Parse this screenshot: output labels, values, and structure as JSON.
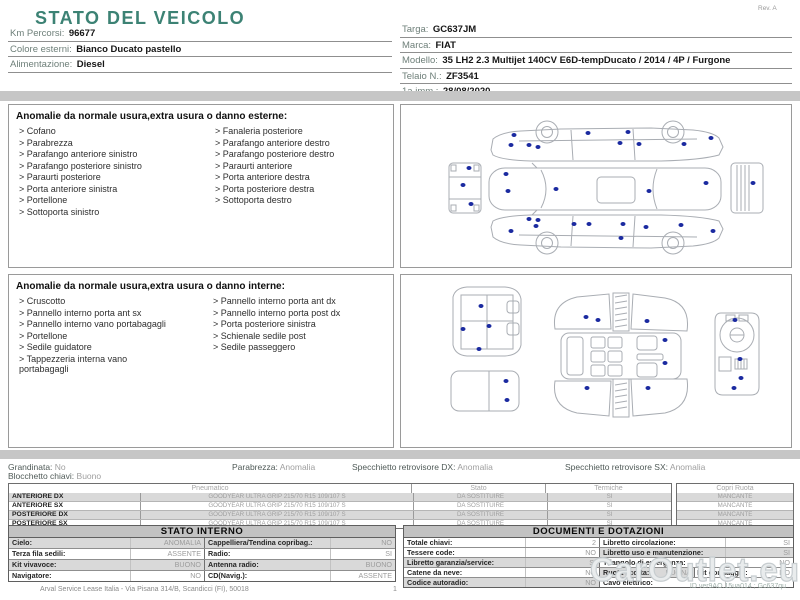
{
  "colors": {
    "accent_teal": "#3c8274",
    "damage_dot": "#1b2aa0",
    "band_gray": "#c6c6c6",
    "shade_gray": "#d9d9d9"
  },
  "header": {
    "title": "STATO DEL VEICOLO",
    "rev": "Rev. A",
    "left_fields": [
      {
        "label": "Km Percorsi:",
        "value": "96677"
      },
      {
        "label": "Colore esterni:",
        "value": "Bianco Ducato pastello"
      },
      {
        "label": "Alimentazione:",
        "value": "Diesel"
      }
    ],
    "right_fields": [
      {
        "label": "Targa:",
        "value": "GC637JM"
      },
      {
        "label": "Marca:",
        "value": "FIAT"
      },
      {
        "label": "Modello:",
        "value": "35 LH2 2.3 Multijet 140CV E6D-tempDucato / 2014 / 4P / Furgone"
      },
      {
        "label": "Telaio N.:",
        "value": "ZF3541"
      },
      {
        "label": "1a imm.:",
        "value": "28/08/2020"
      }
    ]
  },
  "exterior": {
    "title": "Anomalie da normale usura,extra usura o danno esterne:",
    "items_left": [
      "Cofano",
      "Parabrezza",
      "Parafango anteriore sinistro",
      "Parafango posteriore sinistro",
      "Paraurti posteriore",
      "Porta anteriore sinistra",
      "Portellone",
      "Sottoporta sinistro"
    ],
    "items_right": [
      "Fanaleria posteriore",
      "Parafango anteriore destro",
      "Parafango posteriore destro",
      "Paraurti anteriore",
      "Porta anteriore destra",
      "Porta posteriore destra",
      "Sottoporta destro"
    ],
    "dots": [
      [
        113,
        30
      ],
      [
        128,
        40
      ],
      [
        137,
        42
      ],
      [
        110,
        40
      ],
      [
        187,
        28
      ],
      [
        219,
        38
      ],
      [
        227,
        27
      ],
      [
        238,
        39
      ],
      [
        283,
        39
      ],
      [
        310,
        33
      ],
      [
        68,
        63
      ],
      [
        62,
        80
      ],
      [
        70,
        99
      ],
      [
        105,
        69
      ],
      [
        107,
        86
      ],
      [
        155,
        84
      ],
      [
        248,
        86
      ],
      [
        305,
        78
      ],
      [
        352,
        78
      ],
      [
        128,
        114
      ],
      [
        137,
        115
      ],
      [
        135,
        121
      ],
      [
        110,
        126
      ],
      [
        173,
        119
      ],
      [
        188,
        119
      ],
      [
        222,
        119
      ],
      [
        245,
        122
      ],
      [
        280,
        120
      ],
      [
        312,
        126
      ],
      [
        220,
        133
      ]
    ]
  },
  "interior": {
    "title": "Anomalie da normale usura,extra usura o danno interne:",
    "items_left": [
      "Cruscotto",
      "Pannello interno porta ant sx",
      "Pannello interno vano portabagagli",
      "Portellone",
      "Sedile guidatore",
      "Tappezzeria interna vano portabagagli"
    ],
    "items_right": [
      "Pannello interno porta ant dx",
      "Pannello interno porta post dx",
      "Porta posteriore sinistra",
      "Schienale sedile post",
      "Sedile passeggero"
    ],
    "dots": [
      [
        80,
        31
      ],
      [
        88,
        51
      ],
      [
        62,
        54
      ],
      [
        78,
        74
      ],
      [
        105,
        106
      ],
      [
        106,
        125
      ],
      [
        185,
        42
      ],
      [
        197,
        45
      ],
      [
        246,
        46
      ],
      [
        264,
        65
      ],
      [
        264,
        88
      ],
      [
        186,
        113
      ],
      [
        247,
        113
      ],
      [
        334,
        45
      ],
      [
        339,
        84
      ],
      [
        340,
        103
      ],
      [
        333,
        113
      ]
    ]
  },
  "status_line": {
    "items": [
      {
        "label": "Grandinata:",
        "value": "No"
      },
      {
        "label": "Parabrezza:",
        "value": "Anomalia"
      },
      {
        "label": "Specchietto retrovisore DX:",
        "value": "Anomalia"
      },
      {
        "label": "Specchietto retrovisore SX:",
        "value": "Anomalia"
      }
    ],
    "second_row": {
      "label": "Blocchetto chiavi:",
      "value": "Buono"
    }
  },
  "tyres": {
    "headers": [
      "Pneumatico",
      "Stato",
      "Termiche",
      "Copri Ruota"
    ],
    "rows": [
      {
        "pos": "ANTERIORE DX",
        "tyre": "GOODYEAR ULTRA GRIP 215/70 R15 109/107 S",
        "stato": "DA SOSTITUIRE",
        "termiche": "SI",
        "copri": "MANCANTE",
        "shaded": true
      },
      {
        "pos": "ANTERIORE SX",
        "tyre": "GOODYEAR ULTRA GRIP 215/70 R15 109/107 S",
        "stato": "DA SOSTITUIRE",
        "termiche": "SI",
        "copri": "MANCANTE",
        "shaded": false
      },
      {
        "pos": "POSTERIORE DX",
        "tyre": "GOODYEAR ULTRA GRIP 215/70 R15 109/107 S",
        "stato": "DA SOSTITUIRE",
        "termiche": "SI",
        "copri": "MANCANTE",
        "shaded": true
      },
      {
        "pos": "POSTERIORE SX",
        "tyre": "GOODYEAR ULTRA GRIP 215/70 R15 109/107 S",
        "stato": "DA SOSTITUIRE",
        "termiche": "SI",
        "copri": "MANCANTE",
        "shaded": false
      }
    ]
  },
  "stato_interno": {
    "title": "STATO INTERNO",
    "rows": [
      {
        "l_label": "Cielo:",
        "l_value": "ANOMALIA",
        "r_label": "Cappelliera/Tendina copribag.:",
        "r_value": "NO",
        "l_shaded": true,
        "r_shaded": true
      },
      {
        "l_label": "Terza fila sedili:",
        "l_value": "ASSENTE",
        "r_label": "Radio:",
        "r_value": "SI",
        "l_shaded": false,
        "r_shaded": false
      },
      {
        "l_label": "Kit vivavoce:",
        "l_value": "BUONO",
        "r_label": "Antenna radio:",
        "r_value": "BUONO",
        "l_shaded": true,
        "r_shaded": true
      },
      {
        "l_label": "Navigatore:",
        "l_value": "NO",
        "r_label": "CD(Navig.):",
        "r_value": "ASSENTE",
        "l_shaded": false,
        "r_shaded": false
      }
    ]
  },
  "documenti": {
    "title": "DOCUMENTI E DOTAZIONI",
    "rows": [
      {
        "l_label": "Totale chiavi:",
        "l_value": "2",
        "r_label": "Libretto circolazione:",
        "r_value": "SI",
        "l_shaded": false,
        "r_shaded": false
      },
      {
        "l_label": "Tessere code:",
        "l_value": "NO",
        "r_label": "Libretto uso e manutenzione:",
        "r_value": "SI",
        "l_shaded": false,
        "r_shaded": true
      },
      {
        "l_label": "Libretto garanzia/service:",
        "l_value": "SI",
        "r_label": "Triangolo di emergenza:",
        "r_value": "NO",
        "l_shaded": true,
        "r_shaded": false
      },
      {
        "l_label": "Catene da neve:",
        "l_value": "NO",
        "r_label": "Ruota scorta:",
        "r_value": "BUONA",
        "l_shaded": false,
        "r_shaded": true,
        "extra": {
          "label": "Kit gonfiaggio:",
          "value": "NO"
        }
      },
      {
        "l_label": "Codice autoradio:",
        "l_value": "NO",
        "r_label": "Cavo elettrico:",
        "r_value": "",
        "l_shaded": true,
        "r_shaded": false
      }
    ]
  },
  "footer": {
    "company": "Arval Service Lease Italia - Via Pisana 314/B, Scandicci (FI), 50018",
    "page": "1"
  },
  "watermark": {
    "text": "CarOutlet.eu",
    "id_line": "ID ver9AO.15ua014 ; Gc637qu"
  }
}
